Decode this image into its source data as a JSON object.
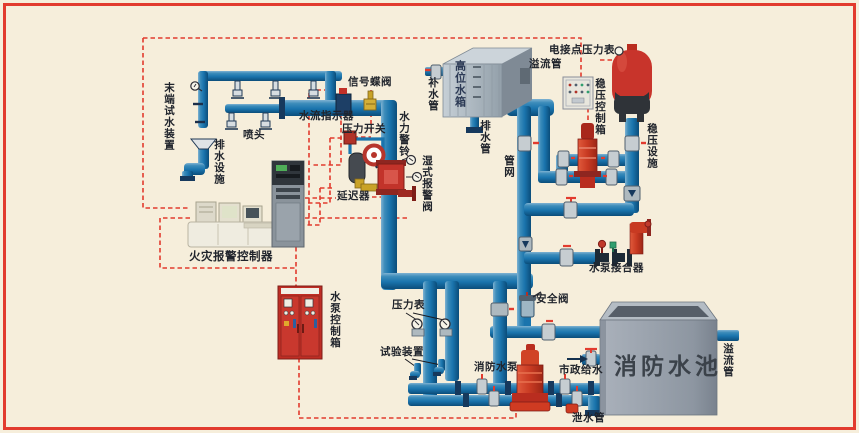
{
  "canvas": {
    "width": 859,
    "height": 433,
    "background": "#f6eedb",
    "border_color": "#e23b2e"
  },
  "colors": {
    "pipe_blue": "#1a74ad",
    "pipe_dark": "#16395d",
    "signal_dashed_red": "#e23b2e",
    "equipment_red": "#c2332a",
    "pump_orange_red": "#d04426",
    "cabinet_red": "#bf2d24",
    "tank_gray": "#a9b3bc",
    "pool_gray": "#99a2ac",
    "valve_gray": "#c6cdd1",
    "label_text": "#20242c"
  },
  "labels": {
    "terminal_test_device": "末端试水装置",
    "sprinkler": "喷头",
    "drain_facility": "排水设施",
    "flow_indicator": "水流指示器",
    "signal_butterfly_valve": "信号蝶阀",
    "pressure_switch": "压力开关",
    "hydraulic_alarm_bell": "水力警铃",
    "retarder": "延迟器",
    "wet_alarm_valve": "湿式报警阀",
    "fire_alarm_controller": "火灾报警控制器",
    "pump_control_cabinet": "水泵控制箱",
    "pressure_gauge": "压力表",
    "test_device": "试验装置",
    "fire_pump": "消防水泵",
    "municipal_water": "市政给水",
    "bottom_drain_pipe": "泄水管",
    "fire_pool": "消防水池",
    "overflow_pipe_pool": "溢流管",
    "pump_adapter": "水泵接合器",
    "safety_valve": "安全阀",
    "pipe_network": "管网",
    "elevated_tank": "高位水箱",
    "makeup_pipe": "补水管",
    "tank_drain_pipe": "排水管",
    "overflow_pipe_tank": "溢流管",
    "electric_contact_gauge": "电接点压力表",
    "stabilizer_control_box": "稳压控制箱",
    "stabilizer_facility": "稳压设施"
  },
  "icons": {
    "municipal_supply_arrow": "right-arrow",
    "electric_contact_gauge_dial": "small-circle-gauge",
    "pressure_gauge_dial": "circle-with-needle"
  }
}
